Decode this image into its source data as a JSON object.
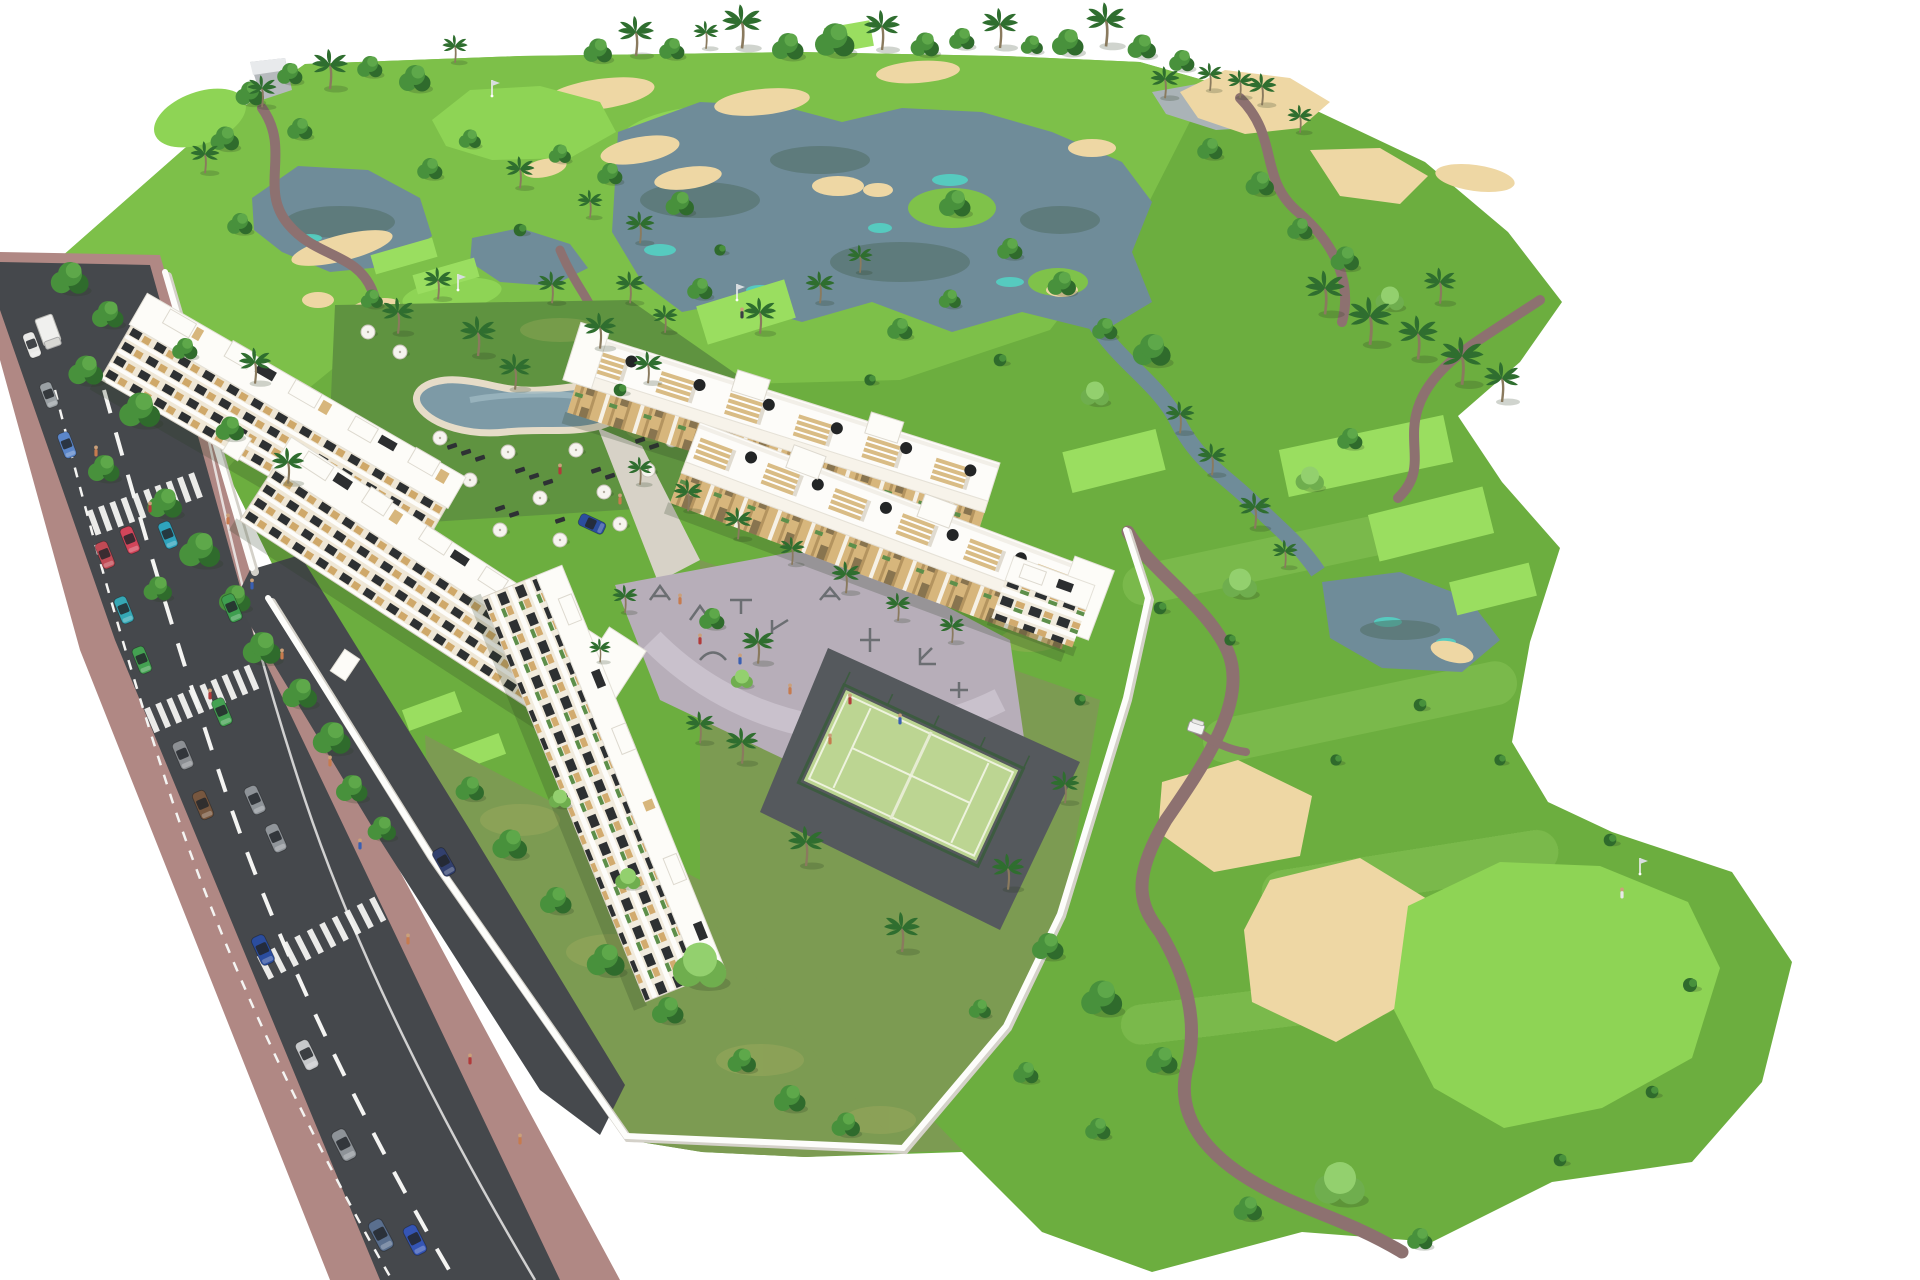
{
  "scene_alt": "Aerial 3D rendering of a golf resort residential complex: white apartment blocks beside a road, swimming pool with umbrellas, playground plaza, padel court, and a large golf course with lakes, sand bunkers, paths, palms and a putting green with flag",
  "colors": {
    "bg": "#ffffff",
    "grass_mid": "#6cae3f",
    "grass_bright": "#7fc24a",
    "grass_light": "#8ed455",
    "tee_green": "#9ade60",
    "lawn": "#5f9340",
    "garden": "#7c9b52",
    "garden_dry": "#b3b264",
    "sand": "#eed7a4",
    "sand_shade": "#dfc291",
    "water": "#6f8c99",
    "water_dark": "#4d6a60",
    "water_teal": "#52d5c5",
    "water_gray": "#aab3b7",
    "pool": "#7d9aa6",
    "pool_deck": "#e6dcc8",
    "path": "#8d7170",
    "path_light": "#d7d2c7",
    "road": "#45484c",
    "sidewalk": "#b08884",
    "marking": "#f4f4f2",
    "plaza": "#b7aeb9",
    "plaza_path": "#c9c1cc",
    "padel": "#bcd592",
    "padel_line": "#eef3de",
    "fence": "#3d5b40",
    "wall": "#fdfdfb",
    "wall_shadow": "#d4d1c9",
    "building": "#fdfcf8",
    "building_shadow": "#e4e1d8",
    "cream": "#efe7d6",
    "tan": "#d7b67c",
    "window": "#2d3032",
    "umb": "#f6f4ef",
    "umb_dark": "#232526",
    "lounger": "#2e3134",
    "tree_dark": "#2f6b2c",
    "tree_mid": "#48913c",
    "tree_hi": "#5ea84a",
    "treeL_base": "#6fae4e",
    "treeL_hi": "#93d06e",
    "palm": "#2f6e2f",
    "trunk": "#8a7a5e",
    "shadow": "rgba(40,60,30,0.22)",
    "cart": "#f4f4f4",
    "flag_pole": "#eeeeee",
    "people_a": "#c77b4e",
    "people_b": "#b23a3a",
    "people_c": "#3a5fb2"
  },
  "vehicles": {
    "parked_colors": [
      "#e9e9e7",
      "#9aa0a4",
      "#5b86c9",
      "#c04a55",
      "#35a7b5",
      "#44a152",
      "#8c8f93",
      "#77573f",
      "#2b4d9e",
      "#c7c9cb",
      "#8e9398",
      "#5a6f8e"
    ],
    "moving_colors": [
      "#d2455a",
      "#2fa3bd",
      "#3e9e4f",
      "#44a152",
      "#8e9398",
      "#90959a",
      "#32406e",
      "#2b4d9e",
      "#3555b5"
    ],
    "truck_color": "#f0f0ee",
    "golf_cart_color": "#f4f4f4"
  },
  "amenities": [
    "golf-course",
    "lakes",
    "swimming-pool",
    "padel-court",
    "playground-plaza",
    "apartment-blocks",
    "road"
  ]
}
